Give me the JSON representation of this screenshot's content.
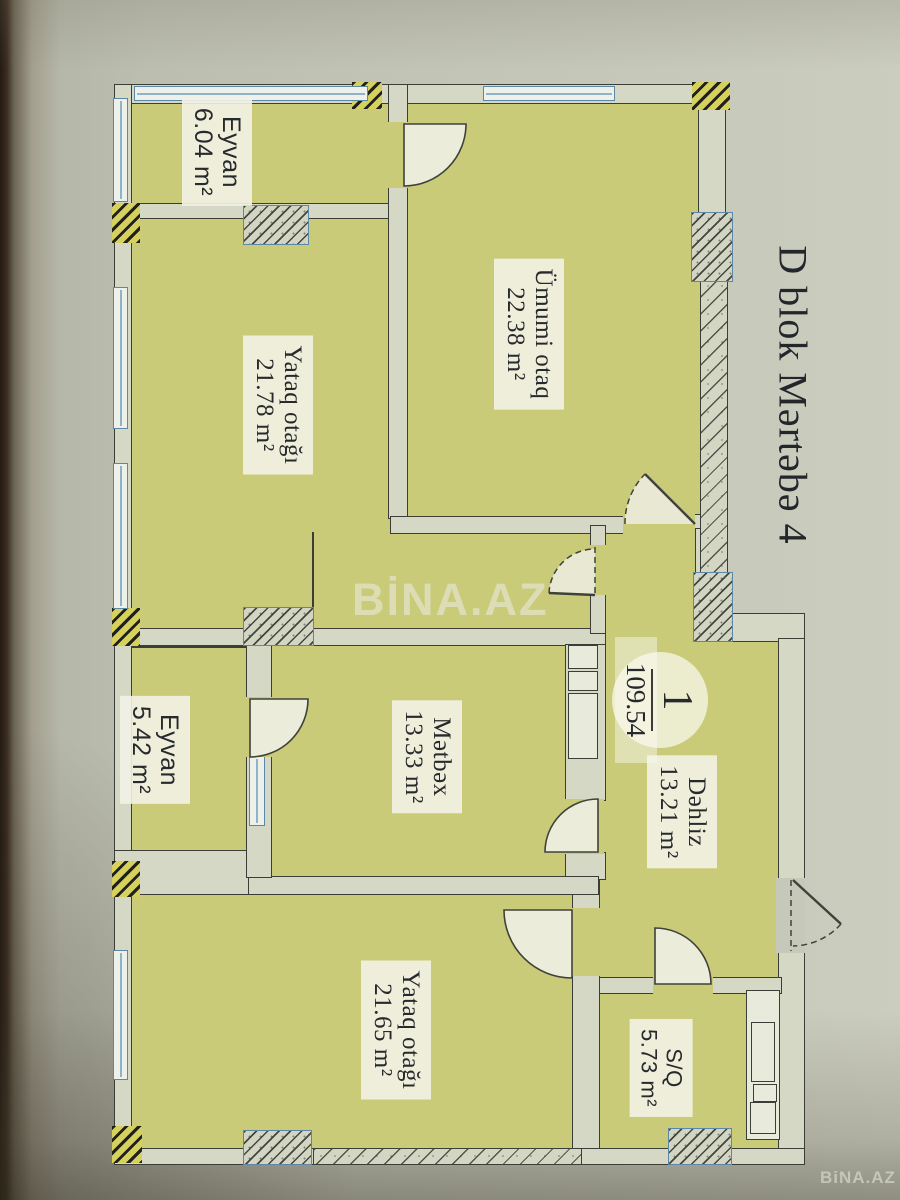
{
  "title": "D blok Mərtəbə 4",
  "unit": {
    "number": "1",
    "total_area": "109.54"
  },
  "rooms": {
    "eyvan_top": {
      "name": "Eyvan",
      "area": "6.04 m²"
    },
    "umumi": {
      "name": "Ümumi otaq",
      "area": "22.38 m²"
    },
    "yataq_top": {
      "name": "Yataq otağı",
      "area": "21.78 m²"
    },
    "eyvan_mid": {
      "name": "Eyvan",
      "area": "5.42 m²"
    },
    "metbex": {
      "name": "Mətbəx",
      "area": "13.33 m²"
    },
    "dehliz": {
      "name": "Dəhliz",
      "area": "13.21 m²"
    },
    "yataq_bottom": {
      "name": "Yataq otağı",
      "area": "21.65 m²"
    },
    "sq": {
      "name": "S/Q",
      "area": "5.73 m²"
    }
  },
  "watermarks": {
    "center": "BİNA.AZ",
    "corner": "BiNA.AZ"
  },
  "colors": {
    "room_fill": "#c9cb78",
    "wall_fill": "#d6d8c6",
    "line": "#3b3e36",
    "window_blue": "#5d87a6",
    "hatch_yellow": "#d6d05c",
    "label_bg": "rgba(243,242,229,0.9)",
    "ink": "#272a2d",
    "wm": "#e9eadd"
  }
}
